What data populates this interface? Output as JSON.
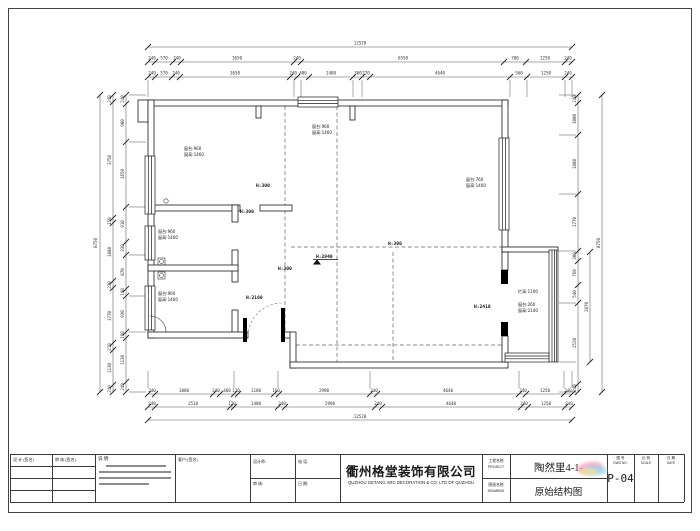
{
  "title_block": {
    "company_cn": "衢州格堂装饰有限公司",
    "company_en": "QUZHOU GETANG ARC DECORATION  &   CO. LTD OF QUZHOU",
    "project_label": "工程名称",
    "project_label_en": "PROJECT",
    "project_value": "陶然里4-1-",
    "drawing_label": "图纸名称",
    "drawing_label_en": "DRAWING",
    "drawing_value": "原始结构图",
    "sheet_label": "图 号",
    "sheet_label_en": "DWG NO.",
    "sheet_value": "P-04",
    "scale_label": "比 例",
    "scale_label_en": "SCALE",
    "date_label": "日 期",
    "date_label_en": "DATE",
    "sign_col1": "设 计 (签名)",
    "sign_col2": "审 核 (签名)",
    "notes_label": "说 明:",
    "client_label": "客户:(签名)",
    "field1": "设计师:",
    "field2": "电 话:",
    "field3": "审 核:",
    "field4": "日 期:"
  },
  "dims": {
    "top_total": "12520",
    "top_row1": [
      "240",
      "570",
      "240",
      "3650",
      "240",
      "6550",
      "700",
      "1250",
      "240"
    ],
    "top_row2": [
      "240",
      "570",
      "240",
      "3650",
      "240",
      "400",
      "1480",
      "300",
      "270",
      "4640",
      "560",
      "1250",
      "240"
    ],
    "bottom_row1": [
      "240",
      "1880",
      "240",
      "460",
      "120",
      "1180",
      "160",
      "2990",
      "240",
      "4640",
      "240",
      "1250",
      "240"
    ],
    "bottom_row2": [
      "240",
      "2510",
      "120",
      "1480",
      "240",
      "2990",
      "240",
      "4640",
      "240",
      "1250",
      "240"
    ],
    "bottom_total": "12520",
    "left_total": "8750",
    "left_mid": [
      "240",
      "3750",
      "150",
      "1880",
      "230",
      "1770",
      "210",
      "1130",
      "240"
    ],
    "left_inner": [
      "240",
      "980",
      "1650",
      "910",
      "330",
      "870",
      "190",
      "930",
      "160",
      "1130",
      "240"
    ],
    "right_inner": [
      "240",
      "1000",
      "1800",
      "1770",
      "300",
      "760",
      "540",
      "2520",
      "240"
    ],
    "right_balcony": "2870",
    "right_total": "8750"
  },
  "plan_labels": {
    "h300": "H:300",
    "h2840": "H:2840",
    "h2160": "H:2160",
    "h2410": "H:2410",
    "sill960": "窗台:960",
    "wh1460": "窗高:1460",
    "sill760": "窗台:760",
    "wh1400": "窗高:1400",
    "rail1100": "栏高:1100",
    "sill260": "窗台:260",
    "wh2140": "窗高:2140"
  }
}
